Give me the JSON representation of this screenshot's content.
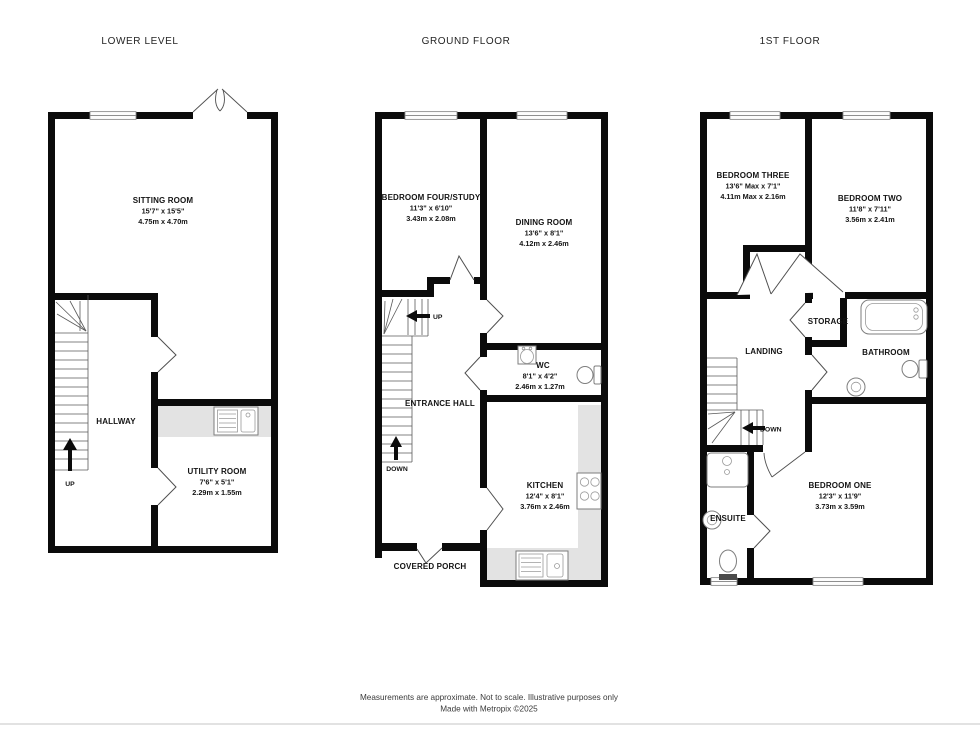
{
  "titles": {
    "lower": "LOWER LEVEL",
    "ground": "GROUND FLOOR",
    "first": "1ST FLOOR"
  },
  "lower": {
    "sitting": {
      "name": "SITTING ROOM",
      "imp": "15'7\" x 15'5\"",
      "met": "4.75m x 4.70m"
    },
    "hallway": {
      "name": "HALLWAY"
    },
    "utility": {
      "name": "UTILITY ROOM",
      "imp": "7'6\" x 5'1\"",
      "met": "2.29m x 1.55m"
    },
    "up_label": "UP"
  },
  "ground": {
    "bed4": {
      "name": "BEDROOM FOUR/STUDY",
      "imp": "11'3\" x 6'10\"",
      "met": "3.43m x 2.08m"
    },
    "dining": {
      "name": "DINING ROOM",
      "imp": "13'6\" x 8'1\"",
      "met": "4.12m x 2.46m"
    },
    "entrance": {
      "name": "ENTRANCE HALL"
    },
    "wc": {
      "name": "WC",
      "imp": "8'1\" x 4'2\"",
      "met": "2.46m x 1.27m"
    },
    "kitchen": {
      "name": "KITCHEN",
      "imp": "12'4\" x 8'1\"",
      "met": "3.76m x 2.46m"
    },
    "porch": {
      "name": "COVERED PORCH"
    },
    "up_label": "UP",
    "down_label": "DOWN"
  },
  "first": {
    "bed3": {
      "name": "BEDROOM THREE",
      "imp": "13'6\" Max x 7'1\"",
      "met": "4.11m Max x 2.16m"
    },
    "bed2": {
      "name": "BEDROOM TWO",
      "imp": "11'8\" x 7'11\"",
      "met": "3.56m x 2.41m"
    },
    "bed1": {
      "name": "BEDROOM ONE",
      "imp": "12'3\" x 11'9\"",
      "met": "3.73m x 3.59m"
    },
    "landing": {
      "name": "LANDING"
    },
    "storage": {
      "name": "STORAGE"
    },
    "bathroom": {
      "name": "BATHROOM"
    },
    "ensuite": {
      "name": "ENSUITE"
    },
    "down_label": "DOWN"
  },
  "footer": {
    "line1": "Measurements are approximate.  Not to scale.  Illustrative purposes only",
    "line2": "Made with Metropix ©2025"
  },
  "colors": {
    "wall": "#0b0b0b",
    "counter": "#e3e3e3",
    "accent_line": "#4f4f4f"
  }
}
